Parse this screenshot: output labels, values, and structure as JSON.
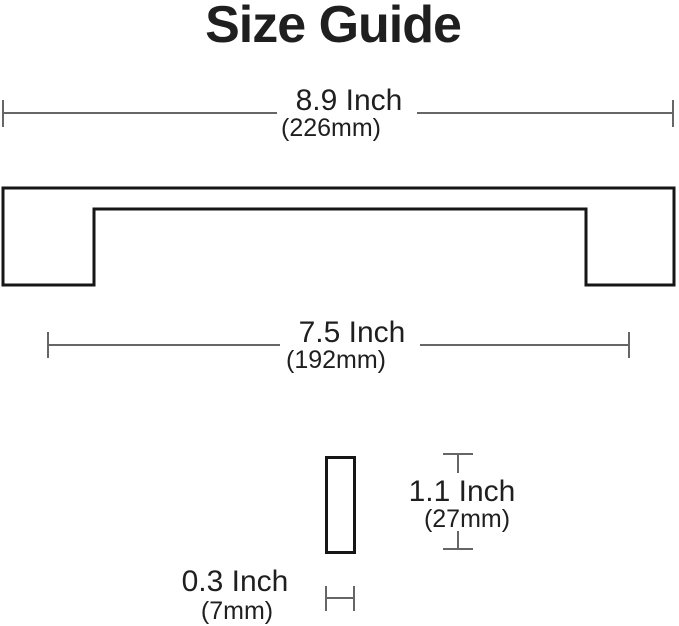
{
  "title": "Size Guide",
  "colors": {
    "text": "#1f1f1f",
    "dimension_line": "#666666",
    "outline": "#161616",
    "background": "#ffffff"
  },
  "dimensions": {
    "overall_length": {
      "inch": "8.9 Inch",
      "mm": "(226mm)"
    },
    "hole_spacing": {
      "inch": "7.5 Inch",
      "mm": "(192mm)"
    },
    "height": {
      "inch": "1.1 Inch",
      "mm": "(27mm)"
    },
    "thickness": {
      "inch": "0.3 Inch",
      "mm": "(7mm)"
    }
  }
}
